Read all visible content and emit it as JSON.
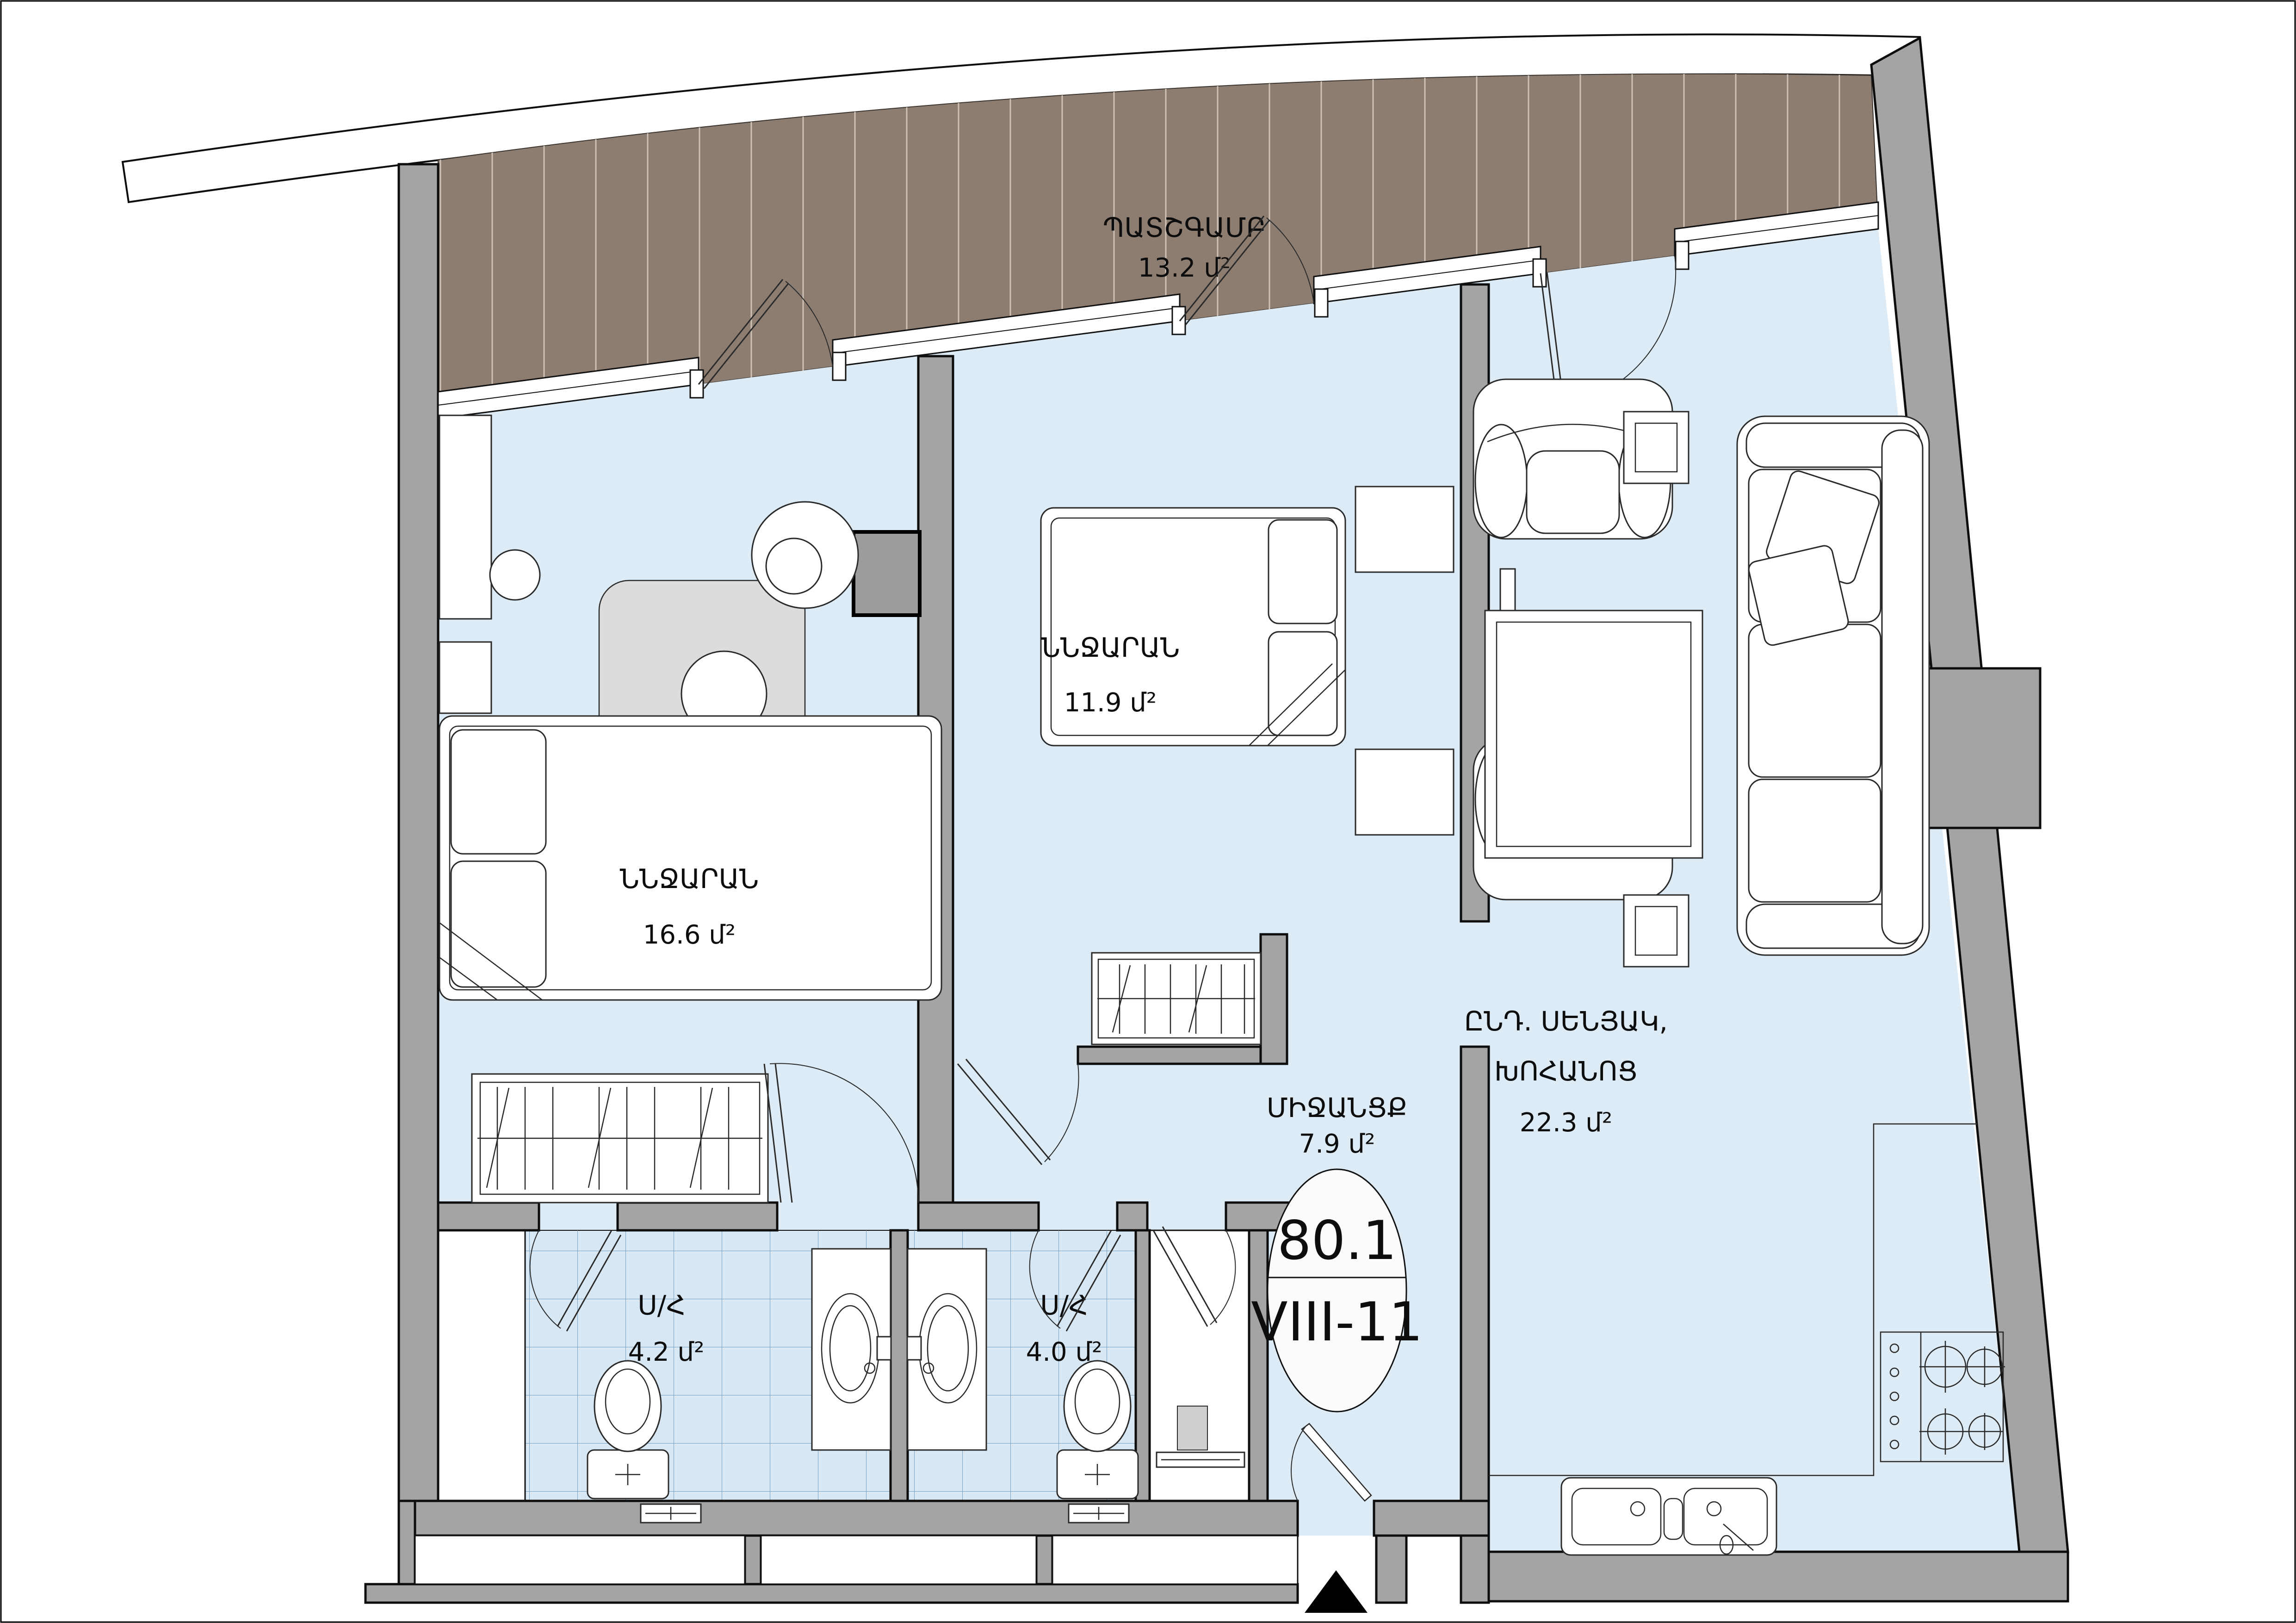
{
  "plan": {
    "balcony": {
      "name": "ՊԱՏՇԳԱՄԲ",
      "area": "13.2 մ²"
    },
    "bedroom_left": {
      "name": "ՆՆՋԱՐԱՆ",
      "area": "16.6 մ²"
    },
    "bedroom_mid": {
      "name": "ՆՆՋԱՐԱՆ",
      "area": "11.9 մ²"
    },
    "living": {
      "name_line1": "ԸՆԴ. ՍԵՆՅԱԿ,",
      "name_line2": "ԽՈՀԱՆՈՑ",
      "area": "22.3 մ²"
    },
    "hallway": {
      "name": "ՄԻՋԱՆՑՔ",
      "area": "7.9 մ²"
    },
    "bath_left": {
      "name": "Ս/Հ",
      "area": "4.2 մ²"
    },
    "bath_right": {
      "name": "Ս/Հ",
      "area": "4.0 մ²"
    },
    "unit": {
      "area_total": "80.1",
      "number": "VIII-11"
    }
  },
  "colors": {
    "floor": "#dcebf6",
    "tile_floor": "#d7e7f3",
    "tile_grid": "#7da0bd",
    "balcony_deck": "#8d7c70",
    "balcony_stripe": "#cdc3b8",
    "wall": "#a4a4a4",
    "outline": "#0d0d0d"
  }
}
